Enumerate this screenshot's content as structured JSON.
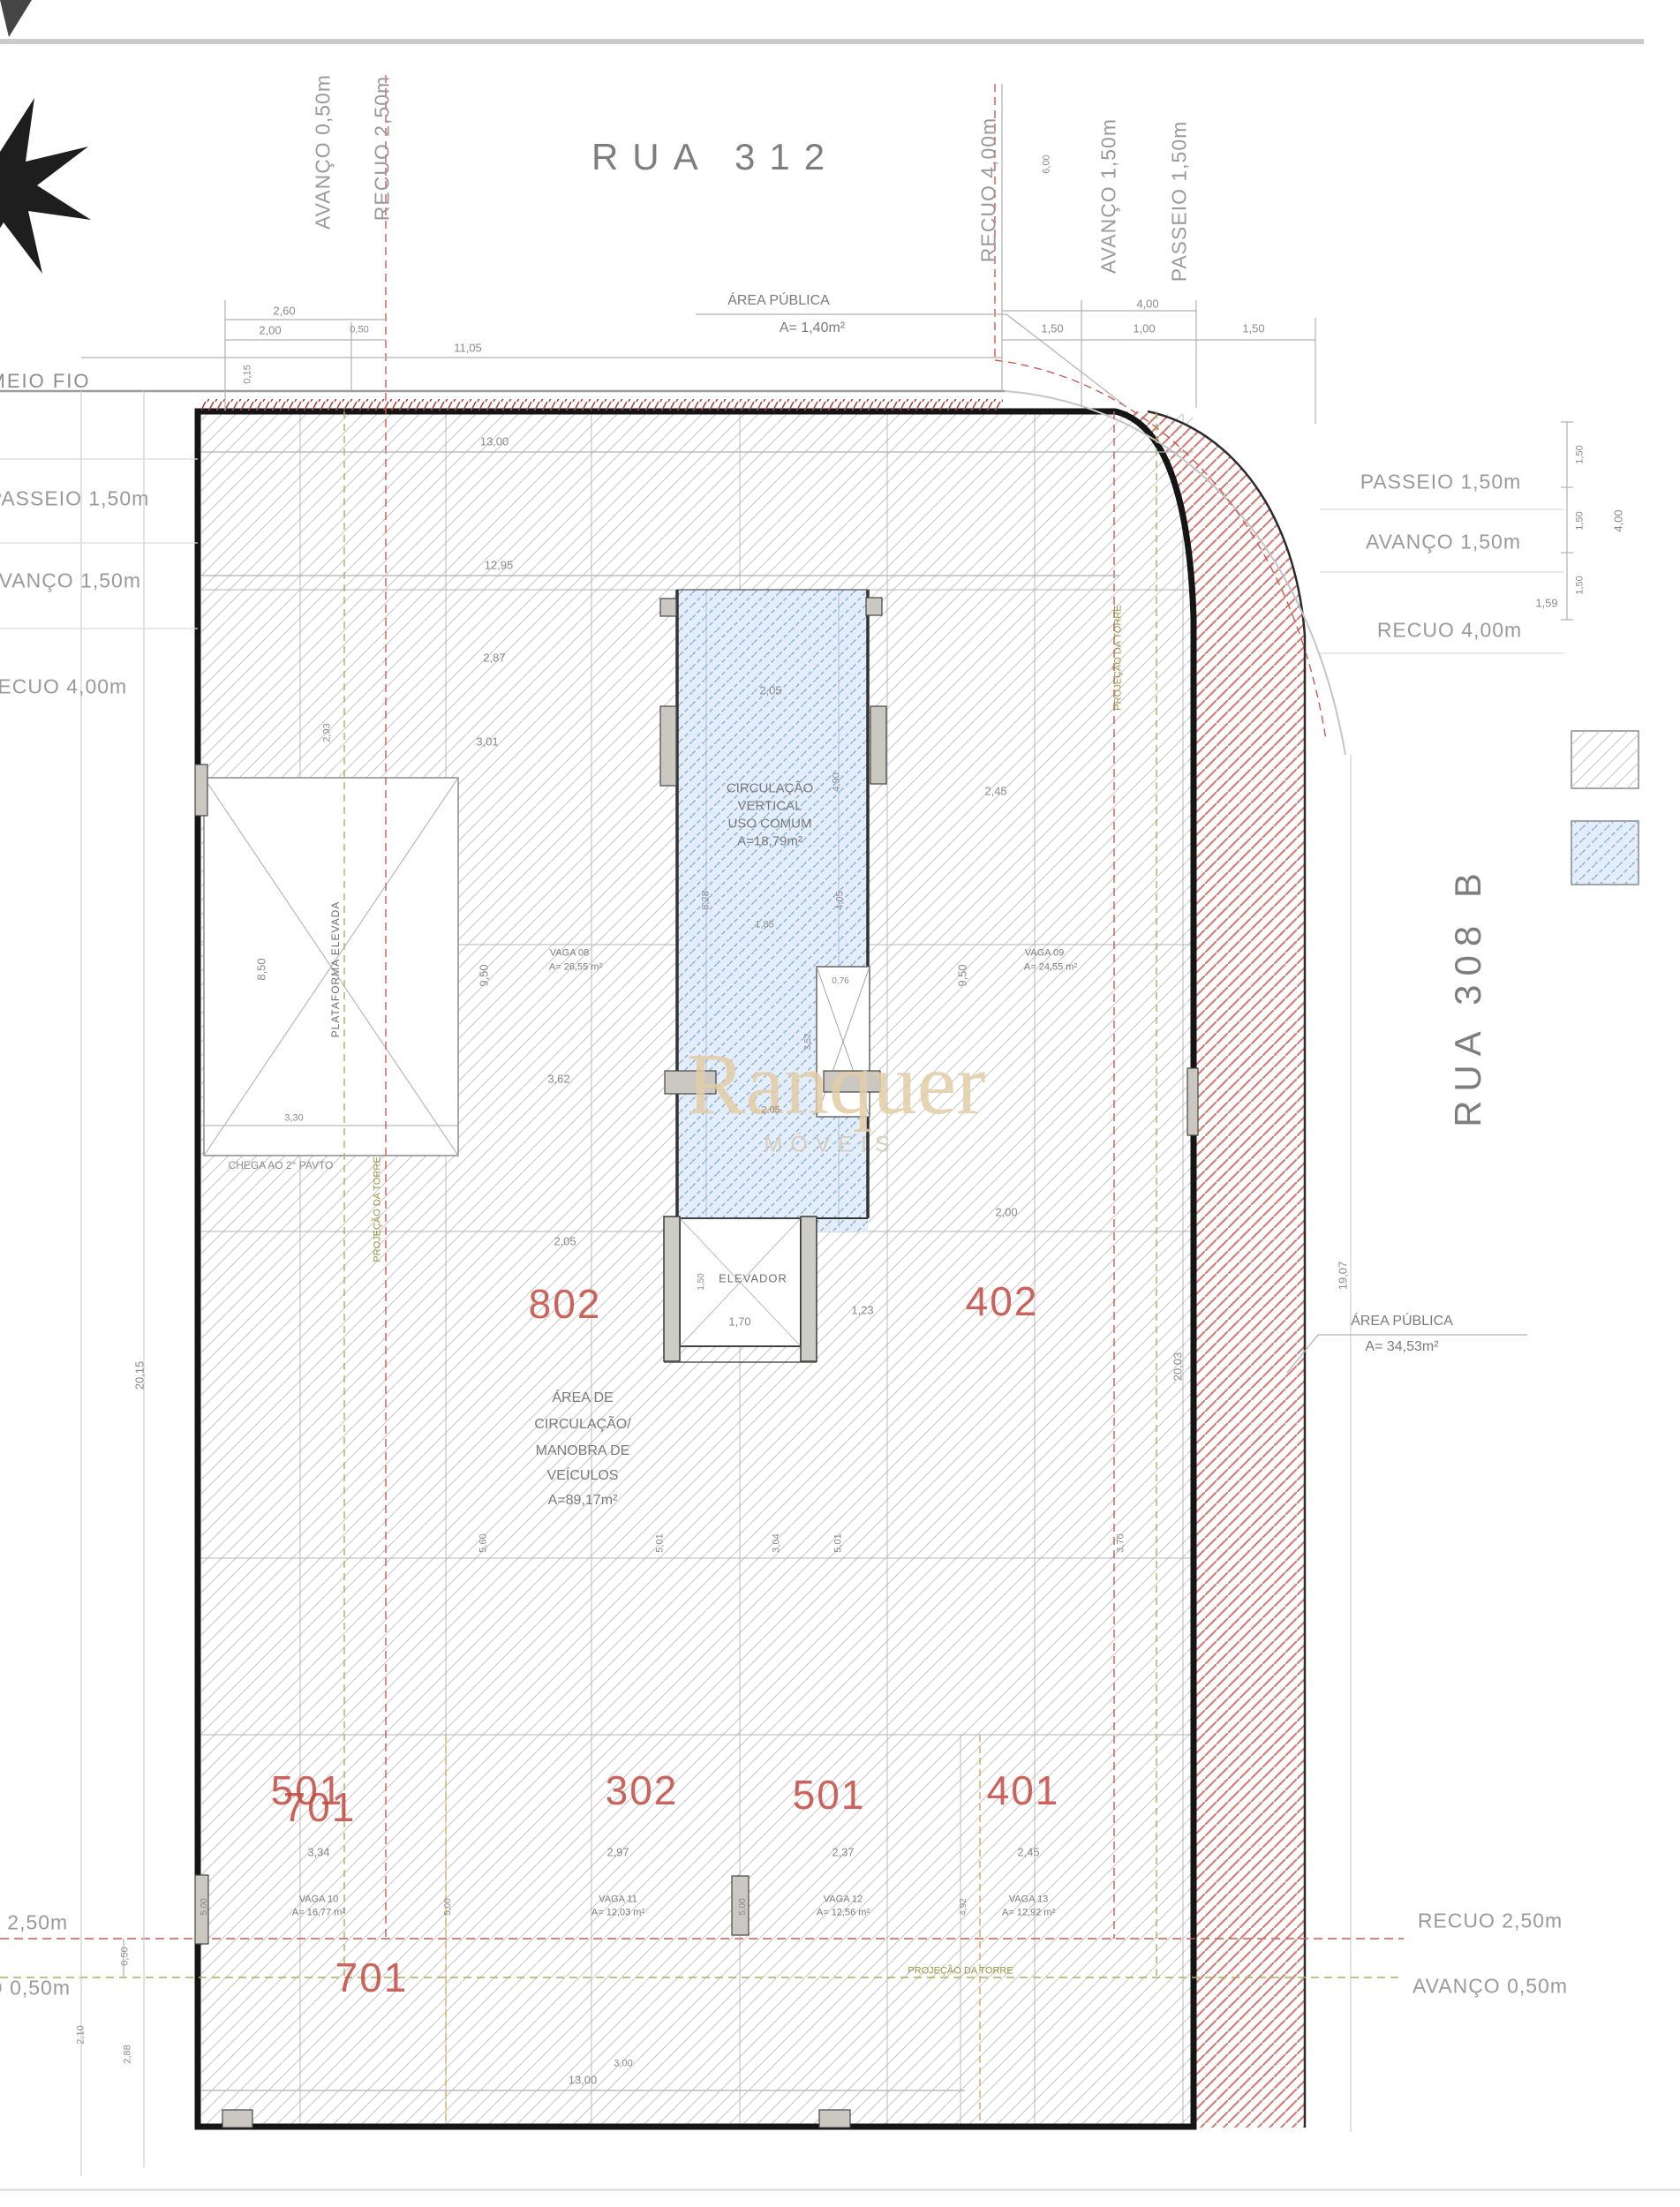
{
  "streets": {
    "top": "RUA 312",
    "right": "RUA 308 B",
    "curb": "MEIO FIO"
  },
  "watermark": {
    "name": "Ranquer",
    "sub": "MÓVEIS"
  },
  "setbacks": {
    "top": [
      "AVANÇO 0,50m",
      "RECUO 2,50m",
      "RECUO 4,00m",
      "AVANÇO 1,50m",
      "PASSEIO 1,50m"
    ],
    "left": [
      "PASSEIO 1,50m",
      "AVANÇO 1,50m",
      "RECUO 4,00m"
    ],
    "left_bottom": [
      "RECUO 2,50m",
      "AVANÇO 0,50m"
    ],
    "right": [
      "PASSEIO 1,50m",
      "AVANÇO 1,50m",
      "RECUO 4,00m"
    ],
    "right_bottom": [
      "RECUO 2,50m",
      "AVANÇO 0,50m"
    ]
  },
  "areas": {
    "publica_top": [
      "ÁREA PÚBLICA",
      "A= 1,40m²"
    ],
    "publica_right": [
      "ÁREA PÚBLICA",
      "A= 34,53m²"
    ],
    "circulacao_vertical": [
      "CIRCULAÇÃO",
      "VERTICAL",
      "USO COMUM",
      "A=18,79m²"
    ],
    "manobra": [
      "ÁREA DE",
      "CIRCULAÇÃO/",
      "MANOBRA DE",
      "VEÍCULOS",
      "A=89,17m²"
    ]
  },
  "rooms": {
    "elevador": "ELEVADOR",
    "plataforma": "PLATAFORMA ELEVADA",
    "chega": "CHEGA AO 2° PAVTO",
    "projecao": "PROJEÇÃO DA TORRE"
  },
  "units": {
    "u802": "802",
    "u402": "402",
    "u501a": "501",
    "u701a": "701",
    "u302": "302",
    "u501b": "501",
    "u401": "401",
    "u701b": "701"
  },
  "vagas": [
    {
      "name": "VAGA 08",
      "area": "A= 26,55 m²"
    },
    {
      "name": "VAGA 09",
      "area": "A= 24,55 m²"
    },
    {
      "name": "VAGA 10",
      "area": "A= 16,77 m²"
    },
    {
      "name": "VAGA 11",
      "area": "A= 12,03 m²"
    },
    {
      "name": "VAGA 12",
      "area": "A= 12,56 m²"
    },
    {
      "name": "VAGA 13",
      "area": "A= 12,92 m²"
    }
  ],
  "dims": [
    "2,60",
    "2,00",
    "0,50",
    "0,15",
    "11,05",
    "13,00",
    "12,95",
    "4,00",
    "1,50",
    "1,00",
    "1,50",
    "1,59",
    "1,50",
    "1,50",
    "1,50",
    "4,00",
    "6,00",
    "2,87",
    "3,01",
    "2,93",
    "2,05",
    "4,90",
    "2,45",
    "9,50",
    "9,50",
    "8,28",
    "4,05",
    "1,85",
    "0,76",
    "3,52",
    "3,62",
    "2,05",
    "8,50",
    "3,30",
    "2,00",
    "2,05",
    "1,23",
    "1,70",
    "1,50",
    "20,15",
    "20,03",
    "19,07",
    "5,60",
    "5,01",
    "3,04",
    "5,01",
    "3,70",
    "3,34",
    "2,97",
    "2,37",
    "2,45",
    "5,00",
    "5,00",
    "5,00",
    "4,92",
    "0,50",
    "2,10",
    "2,88",
    "13,00",
    "3,00"
  ],
  "colors": {
    "red_units": "#c34a40",
    "red_hatch": "#d08079",
    "blue_hatch": "#8cb2d8",
    "gray_hatch": "#c6c6c6",
    "green_dash": "#aab05e",
    "orange_dash": "#d8a85f",
    "red_dash": "#cc5a50",
    "watermark": "#e3cda6"
  }
}
